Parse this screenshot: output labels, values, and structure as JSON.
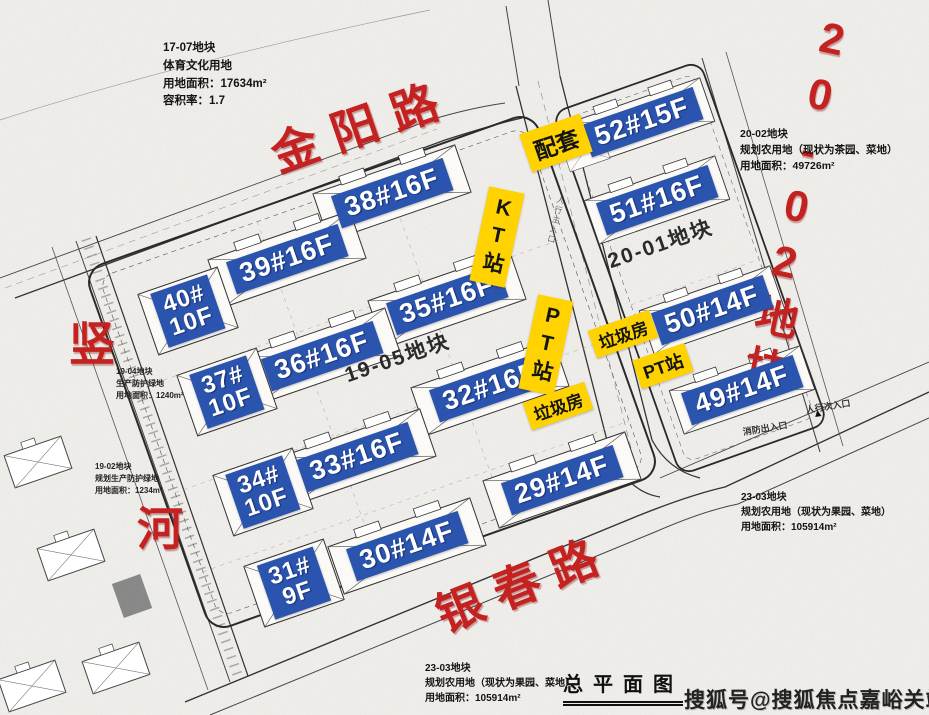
{
  "plan": {
    "title": "总平面图",
    "watermark": "搜狐号@搜狐焦点嘉峪关站",
    "roads": {
      "jinyang": "金阳路",
      "yinchun": "银春路",
      "shu": "竖",
      "he": "河",
      "plot_2002_vertical": "20-02地块"
    },
    "parcels": {
      "p1905": "19-05地块",
      "p2001": "20-01地块"
    },
    "buildings": [
      {
        "id": "38",
        "label": "38#16F"
      },
      {
        "id": "39",
        "label": "39#16F"
      },
      {
        "id": "40",
        "label": "40#\n10F"
      },
      {
        "id": "35",
        "label": "35#16F"
      },
      {
        "id": "36",
        "label": "36#16F"
      },
      {
        "id": "37",
        "label": "37#\n10F"
      },
      {
        "id": "32",
        "label": "32#16F"
      },
      {
        "id": "33",
        "label": "33#16F"
      },
      {
        "id": "34",
        "label": "34#\n10F"
      },
      {
        "id": "30",
        "label": "30#14F"
      },
      {
        "id": "31",
        "label": "31#\n9F"
      },
      {
        "id": "29",
        "label": "29#14F"
      },
      {
        "id": "52",
        "label": "52#15F"
      },
      {
        "id": "51",
        "label": "51#16F"
      },
      {
        "id": "50",
        "label": "50#14F"
      },
      {
        "id": "49",
        "label": "49#14F"
      }
    ],
    "facilities": {
      "peitao": "配套",
      "kt_station": "KT站",
      "pt_station_mid": "PT站",
      "pt_station_right": "PT站",
      "garbage_upper": "垃圾房",
      "garbage_lower": "垃圾房"
    },
    "notes": {
      "n1707": "17-07地块\n体育文化用地\n用地面积：17634m²\n容积率：1.7",
      "n2002": "20-02地块\n规划农用地（现状为茶园、菜地）\n用地面积：49726m²",
      "n1904": "19-04地块\n生产防护绿地\n用地面积：1240m²",
      "n1902": "19-02地块\n规划生产防护绿地\n用地面积：1234m²",
      "n2303_right": "23-03地块\n规划农用地（现状为果园、菜地）\n用地面积：105914m²",
      "n2303_bottom": "23-03地块\n规划农用地（现状为果园、菜地）\n用地面积：105914m²"
    },
    "entrances": {
      "fire": "消防出入口",
      "pedestrian_secondary": "人行次入口",
      "pedestrian_main": "人行主入口"
    },
    "icons": {
      "entrance_marker": "▲"
    },
    "colors": {
      "building_tag_bg": "#2b54ae",
      "facility_tag_bg": "#ffd200",
      "road_text": "#c42121",
      "paper": "#f2f0ec"
    }
  }
}
